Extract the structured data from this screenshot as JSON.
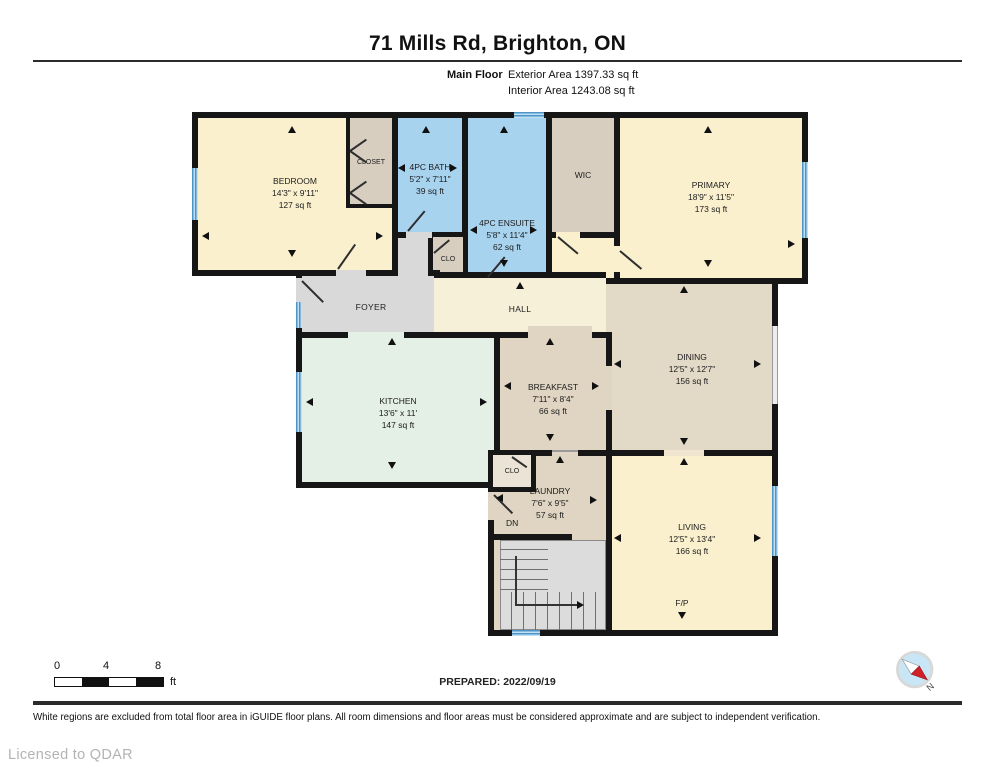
{
  "header": {
    "title": "71 Mills Rd, Brighton, ON",
    "floor_label": "Main Floor",
    "exterior_area": "Exterior Area 1397.33 sq ft",
    "interior_area": "Interior Area 1243.08 sq ft"
  },
  "rooms": {
    "bedroom": {
      "name": "BEDROOM",
      "dims": "14'3\" x 9'11\"",
      "area": "127 sq ft"
    },
    "closet": {
      "name": "CLOSET"
    },
    "bath": {
      "name": "4PC BATH",
      "dims": "5'2\" x 7'11\"",
      "area": "39 sq ft"
    },
    "wic": {
      "name": "WIC"
    },
    "primary": {
      "name": "PRIMARY",
      "dims": "18'9\" x 11'5\"",
      "area": "173 sq ft"
    },
    "ensuite": {
      "name": "4PC ENSUITE",
      "dims": "5'8\" x 11'4\"",
      "area": "62 sq ft"
    },
    "clo_foyer": {
      "name": "CLO"
    },
    "foyer": {
      "name": "FOYER"
    },
    "hall": {
      "name": "HALL"
    },
    "kitchen": {
      "name": "KITCHEN",
      "dims": "13'6\" x 11'",
      "area": "147 sq ft"
    },
    "breakfast": {
      "name": "BREAKFAST",
      "dims": "7'11\" x 8'4\"",
      "area": "66 sq ft"
    },
    "dining": {
      "name": "DINING",
      "dims": "12'5\" x 12'7\"",
      "area": "156 sq ft"
    },
    "clo_laundry": {
      "name": "CLO"
    },
    "laundry": {
      "name": "LAUNDRY",
      "dims": "7'6\" x 9'5\"",
      "area": "57 sq ft"
    },
    "living": {
      "name": "LIVING",
      "dims": "12'5\" x 13'4\"",
      "area": "166 sq ft"
    },
    "dn_label": "DN",
    "fireplace_label": "F/P"
  },
  "footer": {
    "scale": {
      "t0": "0",
      "t4": "4",
      "t8": "8",
      "unit": "ft"
    },
    "prepared": "PREPARED: 2022/09/19",
    "compass_n": "N",
    "disclaimer": "White regions are excluded from total floor area in iGUIDE floor plans. All room dimensions and floor areas must be considered approximate and are subject to independent verification.",
    "license": "Licensed to QDAR"
  },
  "palette": {
    "wall": "#161616",
    "room_cream": "#FAF0CE",
    "room_tan": "#D8CEC0",
    "room_tan_light": "#E0D5C3",
    "room_blue": "#A8D3EF",
    "kitchen_mint": "#E4EFE5",
    "foyer_gray": "#D9D9D9",
    "hall_cream": "#F7F0D9",
    "window_blue": "#4D94C8",
    "compass_fill": "#C9E6F7",
    "compass_needle_red": "#D31F26"
  },
  "icons": [
    "compass-icon",
    "window",
    "door-swing",
    "dimension-arrow-icon",
    "staircase",
    "scale-bar"
  ]
}
